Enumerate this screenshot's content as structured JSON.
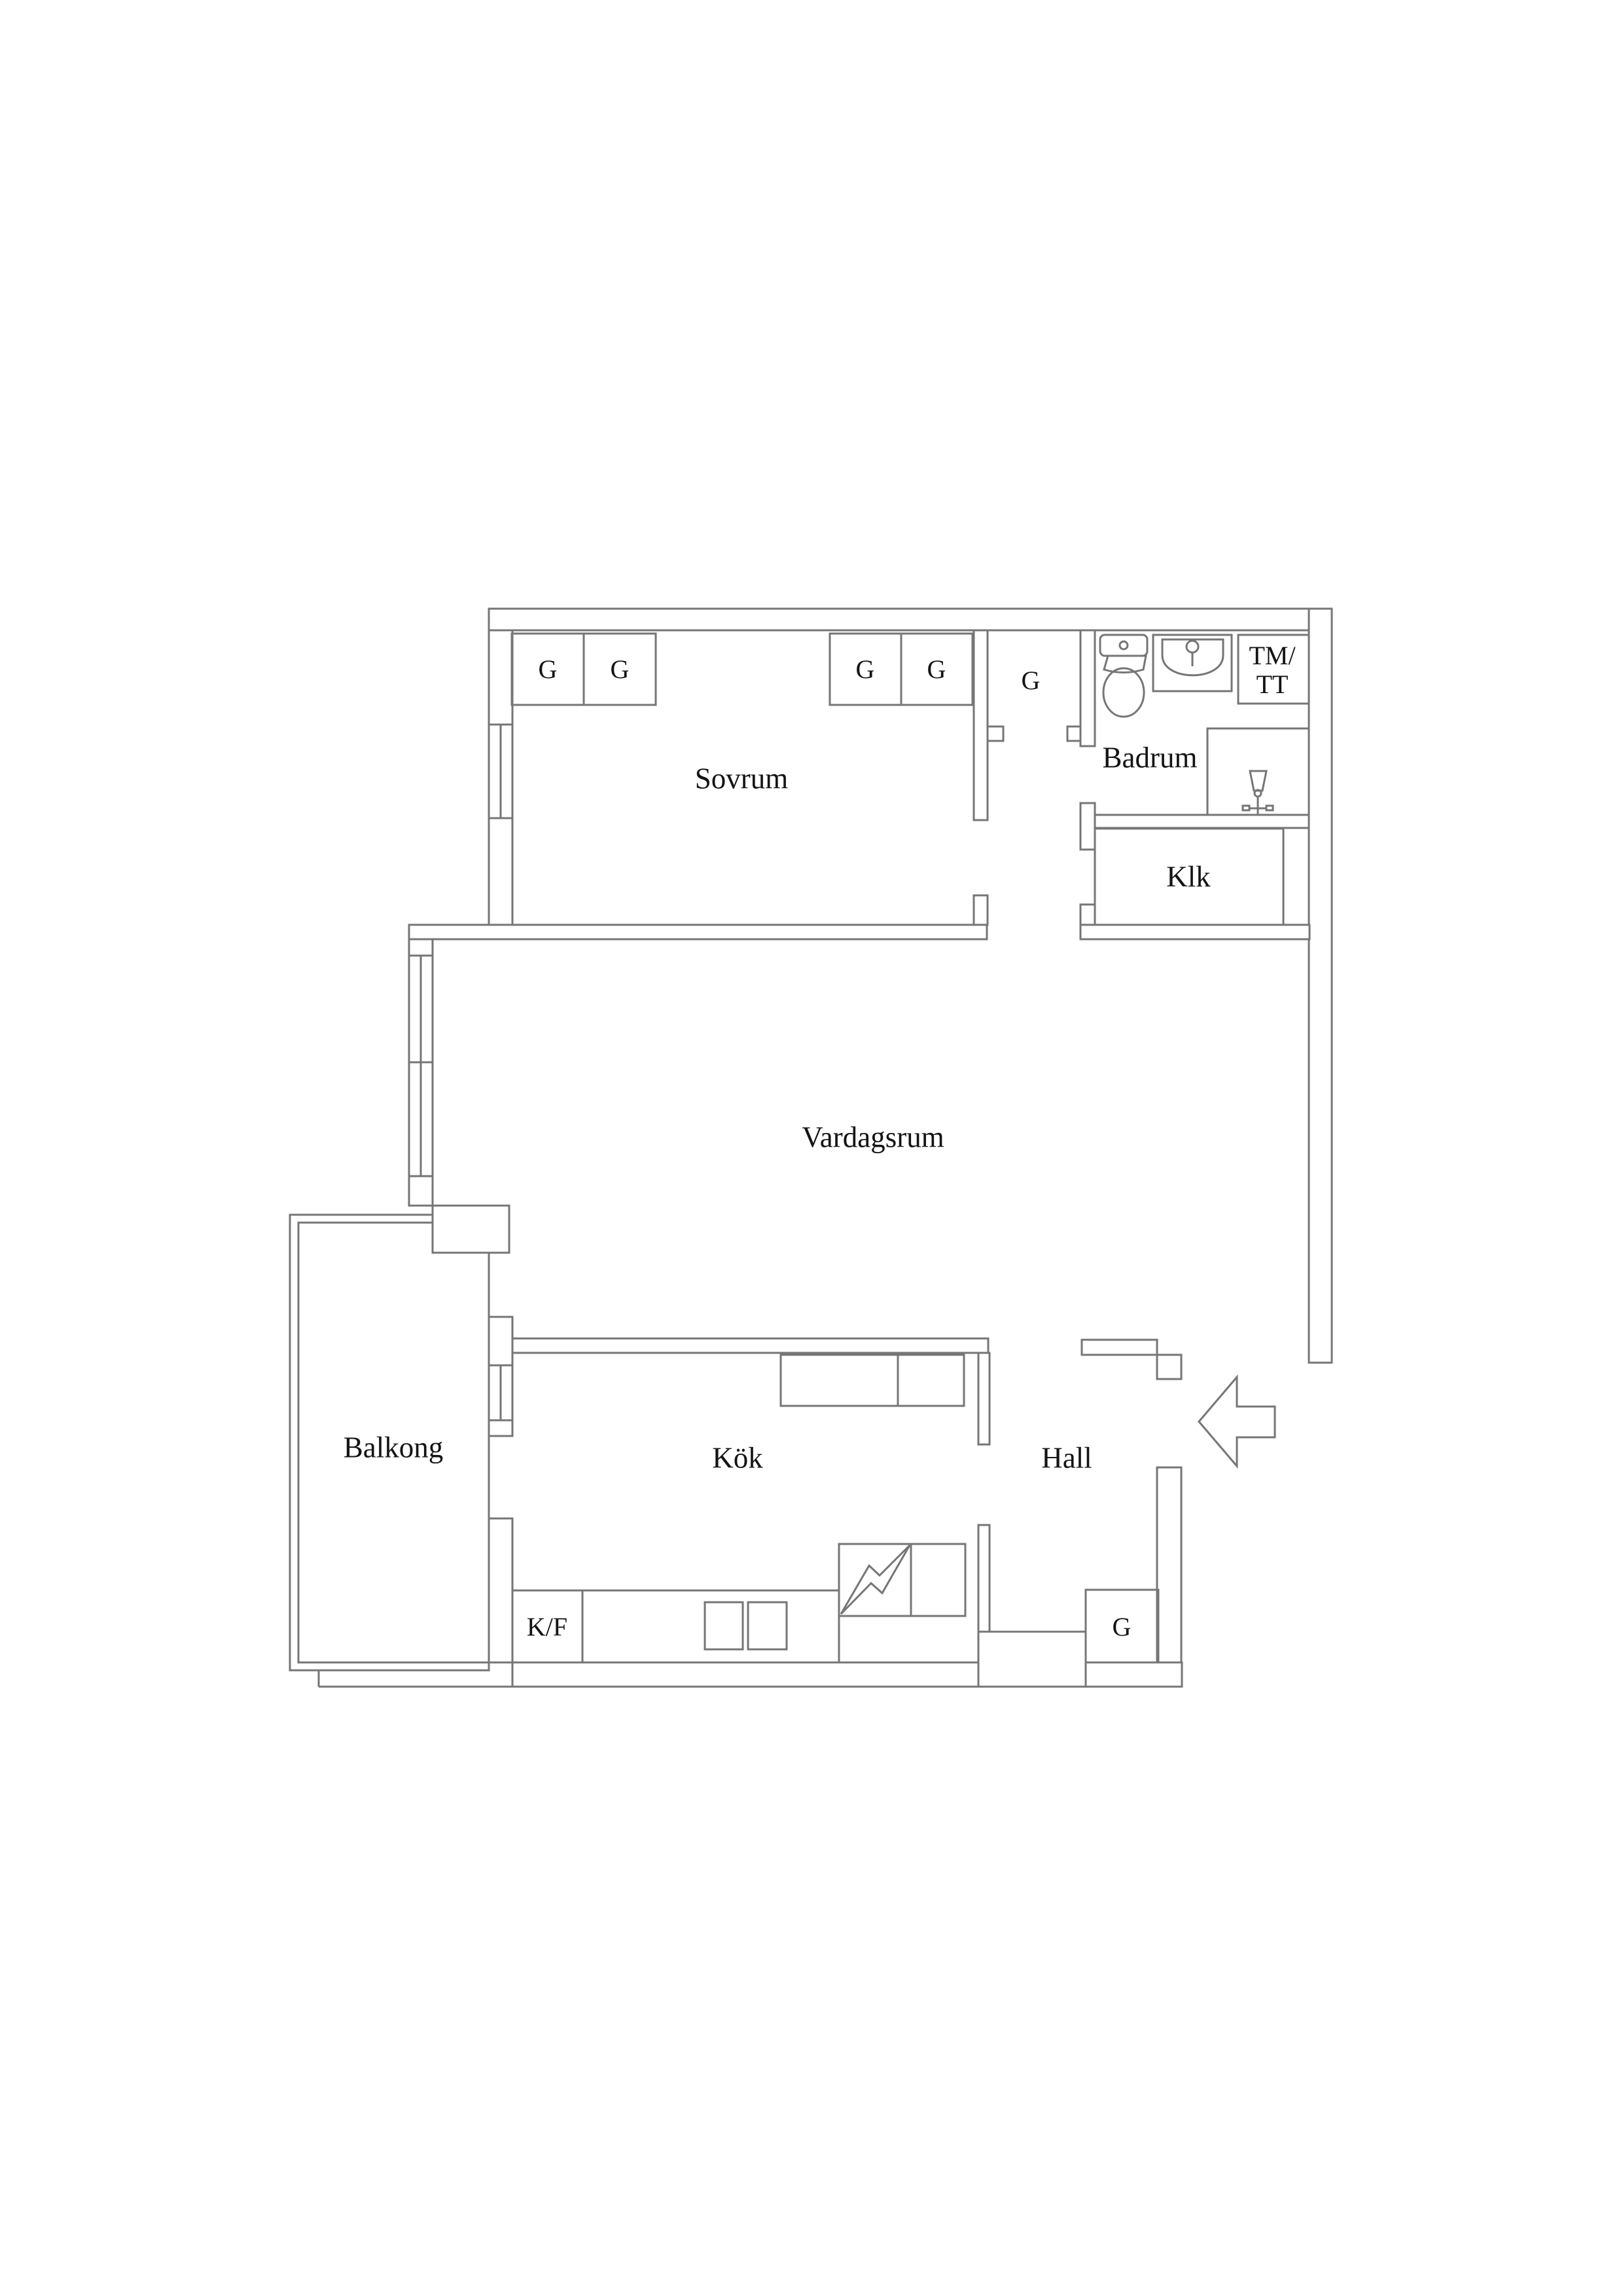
{
  "colors": {
    "background": "#ffffff",
    "line": "#767676",
    "text": "#141414"
  },
  "rooms": {
    "sovrum": {
      "label": "Sovrum"
    },
    "vardagsrum": {
      "label": "Vardagsrum"
    },
    "kok": {
      "label": "Kök"
    },
    "hall": {
      "label": "Hall"
    },
    "balkong": {
      "label": "Balkong"
    },
    "badrum": {
      "label": "Badrum"
    },
    "klk": {
      "label": "Klk"
    }
  },
  "fixtures": {
    "wardrobe_label": "G",
    "fridge_freezer_label": "K/F",
    "washing_machine_label": "TM/",
    "tumble_dryer_label": "TT"
  },
  "icons": {
    "toilet": "toilet-icon",
    "sink": "sink-icon",
    "shower_mixer": "shower-mixer-icon",
    "stove": "stove-lightning-icon",
    "entrance": "entrance-arrow-icon"
  }
}
